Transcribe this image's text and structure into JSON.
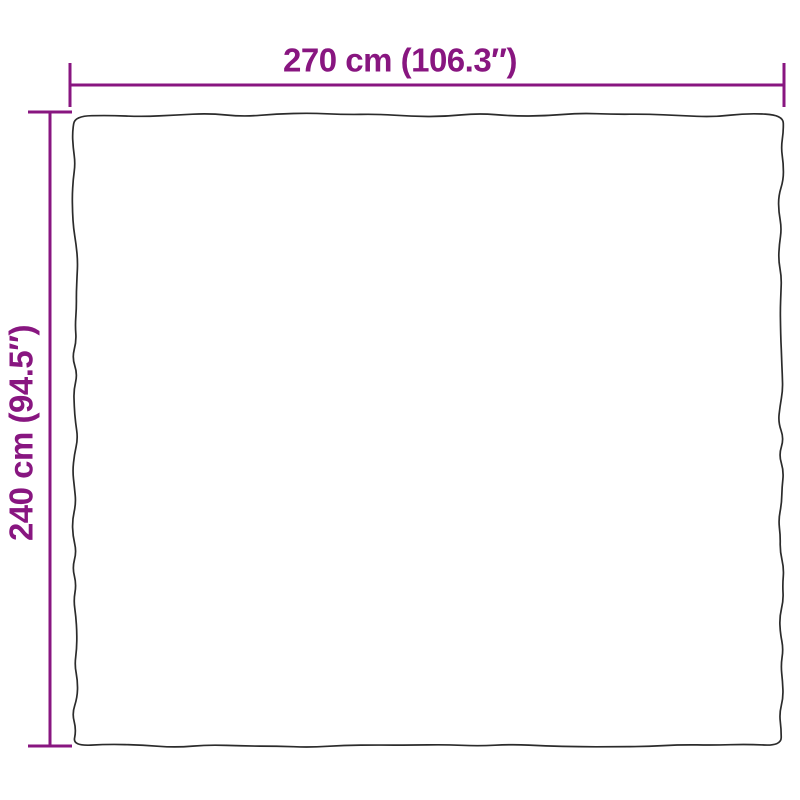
{
  "diagram": {
    "width_label": "270 cm (106.3″)",
    "height_label": "240 cm (94.5″)",
    "width_cm": "270",
    "width_inches": "106.3",
    "height_cm": "240",
    "height_inches": "94.5",
    "colors": {
      "dimension": "#881680",
      "outline": "#2b2b2b",
      "background": "#ffffff"
    }
  }
}
